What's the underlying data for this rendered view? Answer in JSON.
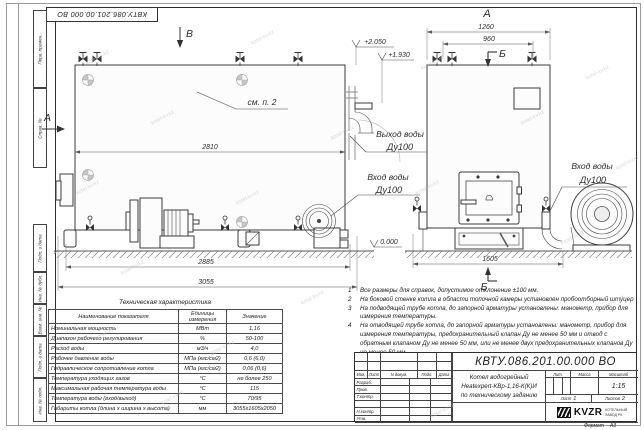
{
  "watermark": {
    "text": "kotel-kv.kz"
  },
  "frame": {
    "corner_stamp": "КВТУ.086.201.00.000 ВО",
    "left_labels": [
      "Перв. примен.",
      "Справ. №",
      "Подп. и дата",
      "Инв. № дубл.",
      "Взам. инв. №",
      "Подп. и дата",
      "Инв. № подл."
    ],
    "format_label": "Формат",
    "format_value": "А3"
  },
  "side_view": {
    "view_mark_top": "В",
    "view_mark_left": "А",
    "see_note": "см. п. 2",
    "dims": {
      "body_width": "2810",
      "base_width": "2885",
      "overall_length": "3055"
    },
    "elevations": {
      "top": "+2.050",
      "outlet": "+1.930",
      "ground": "0.000"
    },
    "outlet_label": {
      "line1": "Выход воды",
      "line2": "Ду100"
    },
    "inlet_label": {
      "line1": "Вход воды",
      "line2": "Ду100"
    }
  },
  "front_view": {
    "view_mark_top": "А",
    "section_mark_top": "Б",
    "section_mark_bottom": "Б",
    "dims": {
      "overall_width": "1260",
      "valve_spacing": "960",
      "base_width": "1605"
    },
    "inlet_label": {
      "line1": "Вход воды",
      "line2": "Ду100"
    }
  },
  "notes": {
    "items": [
      {
        "n": "1",
        "text": "Все размеры для справок, допустимое отклонение ±100 мм."
      },
      {
        "n": "2",
        "text": "На боковой стенке котла в области топочной камеры установлен пробоотборный штуцер"
      },
      {
        "n": "3",
        "text": "На подводящей трубе котла, до запорной арматуры установлены: манометр, прибор для измерения температуры."
      },
      {
        "n": "4",
        "text": "На отводящей трубе котла, до запорной арматуры установлены: манометр, прибор для измерения температуры, предохранительный клапан Ду не менее 50 мм и отвод с обратным клапаном Ду не менее 50 мм, или не менее двух предохранительных клапанов Ду не менее 50 мм."
      }
    ]
  },
  "spec_table": {
    "title": "Техническая характеристика",
    "headers": [
      "Наименование показателя",
      "Единицы измерения",
      "Значение"
    ],
    "rows": [
      {
        "name": "Номинальная мощность",
        "unit": "МВт",
        "value": "1,16"
      },
      {
        "name": "Диапазон рабочего регулирования",
        "unit": "%",
        "value": "50-100"
      },
      {
        "name": "Расход воды",
        "unit": "м3/ч",
        "value": "4,0"
      },
      {
        "name": "Рабочее давление воды",
        "unit": "МПа (кгс/см2)",
        "value": "0,6 (6,0)"
      },
      {
        "name": "Гидравлическое сопротивление котла",
        "unit": "МПа (кгс/см2)",
        "value": "0,06 (0,6)"
      },
      {
        "name": "Температура уходящих газов",
        "unit": "°С",
        "value": "не более 250"
      },
      {
        "name": "Максимальная рабочая температура воды",
        "unit": "°С",
        "value": "115"
      },
      {
        "name": "Температура воды (вход/выход)",
        "unit": "°С",
        "value": "70/95"
      },
      {
        "name": "Габариты котла (длина х ширина х высота)",
        "unit": "мм",
        "value": "3055х1605х2050"
      }
    ]
  },
  "title_block": {
    "doc_number": "КВТУ.086.201.00.000  ВО",
    "product_name_line1": "Котел водогрейный",
    "product_name_line2": "Heatexpert-КВр-1,16-К(К)И",
    "product_name_line3": "по техническому заданию",
    "header_cells": {
      "izm": "Изм.",
      "list": "Лист",
      "doc": "N докум.",
      "podp": "Подп.",
      "data": "Дата"
    },
    "roles": [
      "Разраб.",
      "Пров.",
      "Т.контр.",
      "",
      "Н.контр.",
      "Утв."
    ],
    "lit_label": "Лит.",
    "mass_label": "Масса",
    "scale_label": "Масштаб",
    "scale_value": "1:15",
    "sheet_label": "Лист",
    "sheet_value": "1",
    "sheets_label": "Листов",
    "sheets_value": "2",
    "brand": {
      "name": "KVZR",
      "sub1": "КОТЕЛЬНЫЙ",
      "sub2": "ЗАВОД РК"
    }
  },
  "colors": {
    "line": "#3c3c3c",
    "dim_line": "#555555",
    "ground_hatch": "#8a8a8a",
    "watermark": "#b9c2cc"
  }
}
